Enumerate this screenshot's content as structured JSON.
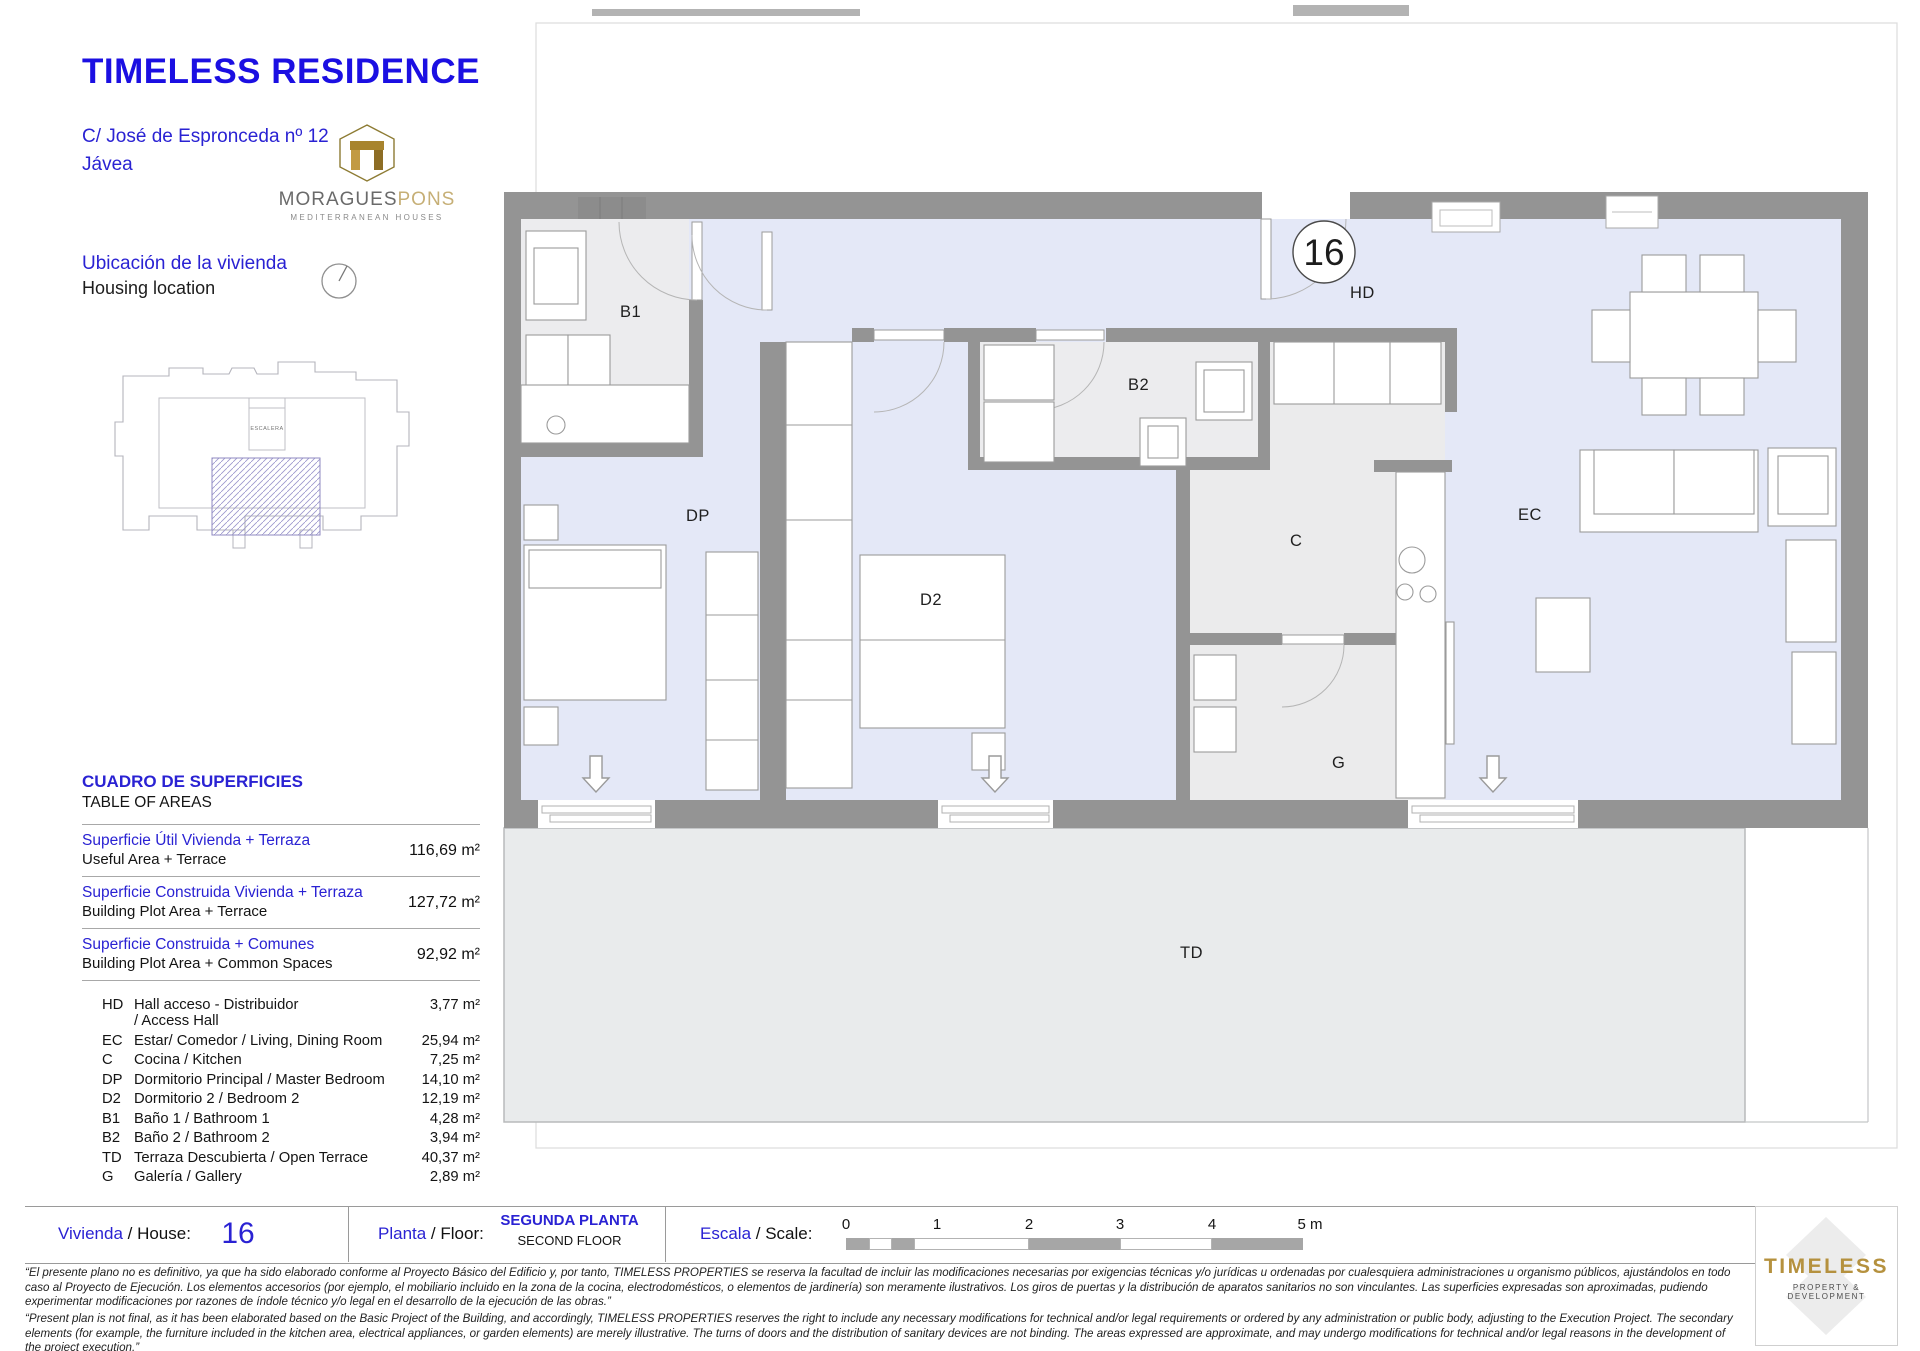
{
  "header": {
    "title": "TIMELESS RESIDENCE",
    "address_line1": "C/ José de Espronceda nº 12",
    "address_line2": "Jávea"
  },
  "brand": {
    "moraguespons": {
      "name_primary": "MORAGUES",
      "name_secondary": "PONS",
      "tagline": "MEDITERRANEAN HOUSES"
    },
    "timeless": {
      "name": "TIMELESS",
      "tagline": "PROPERTY & DEVELOPMENT"
    }
  },
  "location": {
    "label_es": "Ubicación de la vivienda",
    "label_en": "Housing location",
    "stair_label": "ESCALERA"
  },
  "areas": {
    "title_es": "CUADRO DE SUPERFICIES",
    "title_en": "TABLE OF AREAS",
    "summary": [
      {
        "es": "Superficie Útil Vivienda + Terraza",
        "en": "Useful Area + Terrace",
        "value": "116,69 m²"
      },
      {
        "es": "Superficie Construida Vivienda + Terraza",
        "en": "Building Plot Area + Terrace",
        "value": "127,72 m²"
      },
      {
        "es": "Superficie Construida + Comunes",
        "en": "Building Plot Area + Common Spaces",
        "value": "92,92 m²"
      }
    ],
    "rooms": [
      {
        "code": "HD",
        "name": "Hall acceso - Distribuidor",
        "name2": "/ Access Hall",
        "value": "3,77 m²"
      },
      {
        "code": "EC",
        "name": "Estar/ Comedor / Living, Dining Room",
        "name2": "",
        "value": "25,94 m²"
      },
      {
        "code": "C",
        "name": "Cocina  / Kitchen",
        "name2": "",
        "value": "7,25 m²"
      },
      {
        "code": "DP",
        "name": "Dormitorio Principal  / Master Bedroom",
        "name2": "",
        "value": "14,10 m²"
      },
      {
        "code": "D2",
        "name": "Dormitorio 2  / Bedroom 2",
        "name2": "",
        "value": "12,19 m²"
      },
      {
        "code": "B1",
        "name": "Baño 1  / Bathroom 1",
        "name2": "",
        "value": "4,28 m²"
      },
      {
        "code": "B2",
        "name": "Baño 2  / Bathroom 2",
        "name2": "",
        "value": "3,94 m²"
      },
      {
        "code": "TD",
        "name": "Terraza Descubierta  / Open Terrace",
        "name2": "",
        "value": "40,37 m²"
      },
      {
        "code": "G",
        "name": "Galería  / Gallery",
        "name2": "",
        "value": "2,89 m²"
      }
    ]
  },
  "plan": {
    "unit_number": "16",
    "labels": {
      "hd": "HD",
      "ec": "EC",
      "c": "C",
      "dp": "DP",
      "d2": "D2",
      "b1": "B1",
      "b2": "B2",
      "td": "TD",
      "g": "G"
    }
  },
  "footer": {
    "vivienda_es": "Vivienda",
    "vivienda_en": " / House:",
    "house_number": "16",
    "planta_es": "Planta",
    "planta_en": " / Floor:",
    "floor_es": "SEGUNDA PLANTA",
    "floor_en": "SECOND FLOOR",
    "escala_es": "Escala",
    "escala_en": " / Scale:",
    "scale_ticks": [
      "0",
      "1",
      "2",
      "3",
      "4",
      "5 m"
    ],
    "disclaimer_es": "“El presente plano no es definitivo, ya que ha sido elaborado conforme al Proyecto Básico del Edificio y, por tanto, TIMELESS PROPERTIES se reserva la facultad de incluir las modificaciones necesarias por exigencias técnicas y/o jurídicas u ordenadas por cualesquiera administraciones u organismo públicos, ajustándolos en todo caso al Proyecto de Ejecución. Los elementos accesorios (por ejemplo, el mobiliario incluido en la zona de la cocina, electrodomésticos, o elementos de jardinería) son meramente ilustrativos. Los giros de puertas y la distribución de aparatos sanitarios no son vinculantes. Las superficies expresadas son aproximadas, pudiendo experimentar modificaciones por razones de índole técnico y/o legal en el desarrollo de la ejecución de las obras.”",
    "disclaimer_en": "“Present plan is not final, as it has been elaborated based on the Basic Project of the Building, and accordingly, TIMELESS PROPERTIES reserves the right to include any necessary modifications for technical and/or legal requirements or ordered by any administration or public body, adjusting to the Execution Project. The secondary elements (for example, the furniture included in the kitchen area, electrical appliances, or garden elements) are merely illustrative. The turns of doors and the distribution of sanitary devices are not binding. The areas expressed are approximate, and may undergo modifications for technical and/or legal reasons in the development of the project execution.”"
  },
  "colors": {
    "accent_blue": "#2a22d3",
    "title_blue": "#1b0fe2",
    "gold": "#b5913e",
    "wall_gray": "#949494",
    "floor_blue": "#e4e8f7",
    "floor_gray": "#ececee",
    "terrace_gray": "#e9ebec"
  }
}
